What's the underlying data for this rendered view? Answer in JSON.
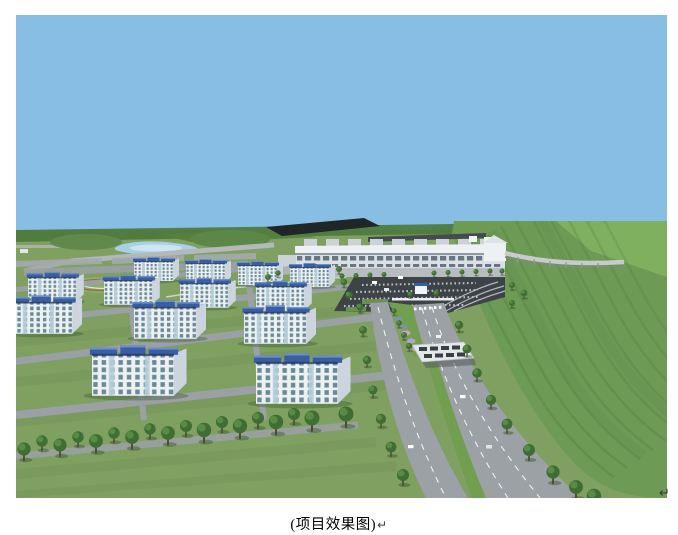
{
  "figure": {
    "type": "architectural-rendering",
    "alt": "Aerial 3D rendering: clusters of white apartment blocks with blue roofs on green lawns, a long white station building with a dark forecourt, a tree-lined highway with a toll canopy running to the lower right, a small lake, a stadium field, and terraced green hills under a clear blue sky",
    "caption": "(项目效果图)",
    "caption_paragraph_mark": "↵",
    "corner_paragraph_mark": "↵",
    "palette": {
      "sky": "#88bee4",
      "grass": "#7fa061",
      "hill_light": "#6d9a55",
      "hill_dark": "#4f7a3e",
      "median_green": "#729e50",
      "road": "#9ba1a5",
      "road_line": "#ffffff",
      "parking": "#3e4347",
      "building_wall": "#edf1f4",
      "building_side": "#ccd5dd",
      "building_window": "#49707e",
      "roof_blue": "#3a5ea6",
      "tree": "#3e6e33",
      "lake": "#a7d0e6",
      "station_white": "#eef1f3",
      "dark_roof": "#202527",
      "flower_pink": "#cf9fc4",
      "flower_purple": "#b1a3d0"
    }
  }
}
